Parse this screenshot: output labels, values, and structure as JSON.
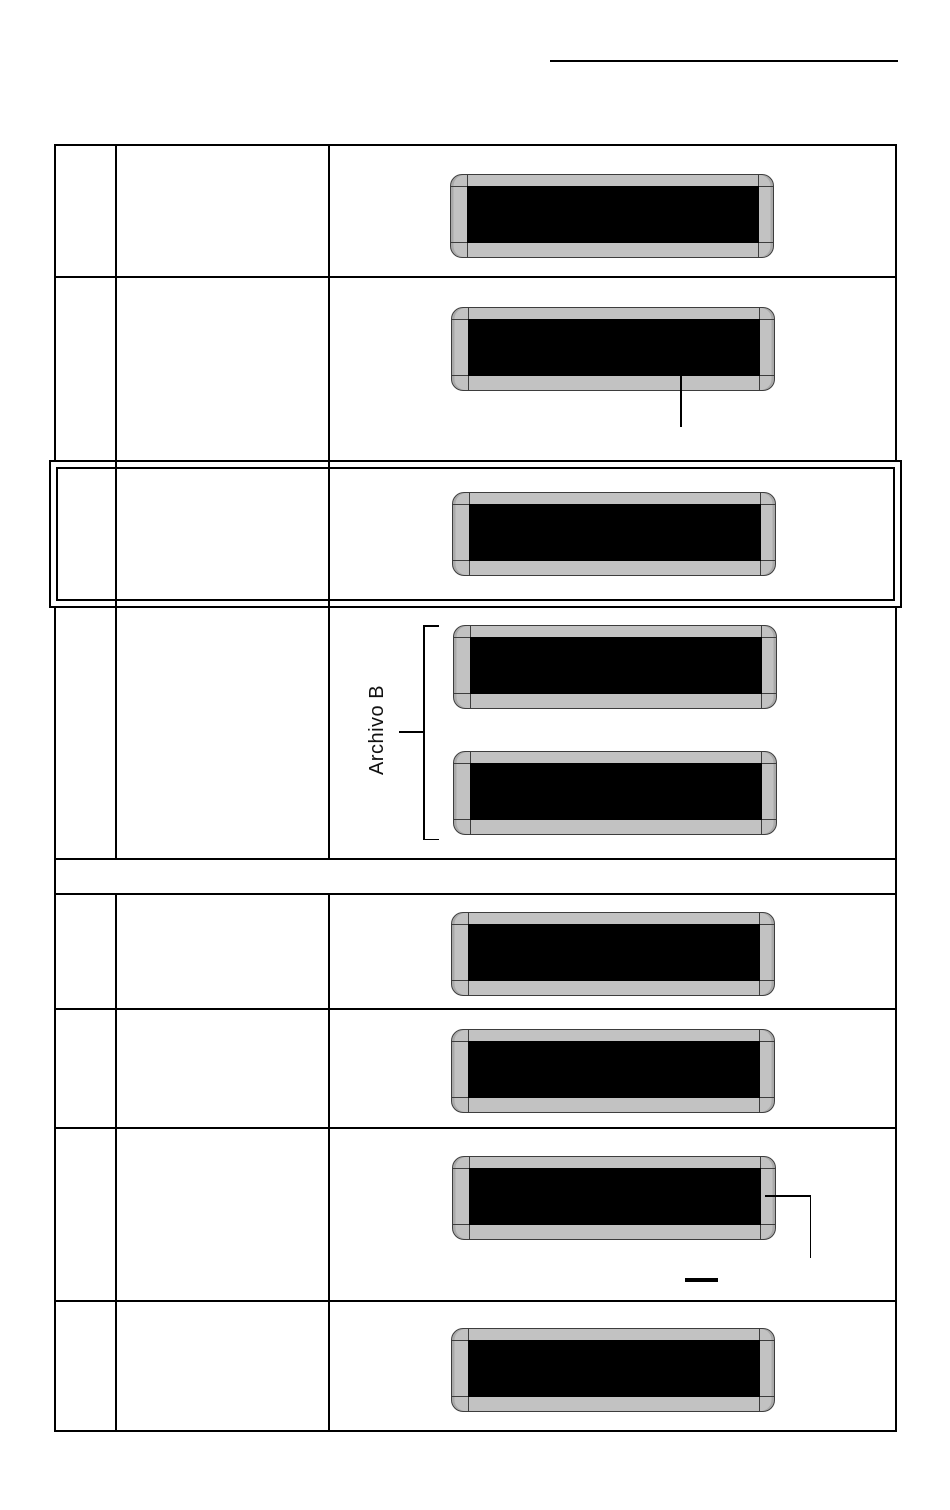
{
  "page": {
    "type": "manual-document-page",
    "background": "#ffffff",
    "header_rule_visible": true
  },
  "labels": {
    "archivo_b": "Archivo B"
  },
  "colors": {
    "table_line": "#000000",
    "lcd_bezel_gray": "#c2c2c2",
    "lcd_screen_black": "#000000",
    "lcd_outline": "#3d3d3d"
  },
  "table": {
    "columns": 3,
    "rows": [
      {
        "index": 1,
        "lcd_displays": 1
      },
      {
        "index": 2,
        "lcd_displays": 1,
        "callout": "line-down-from-display-bottom"
      },
      {
        "index": 3,
        "lcd_displays": 1,
        "highlighted": "double-border-box"
      },
      {
        "index": 4,
        "lcd_displays": 2,
        "bracket_label": "Archivo B"
      },
      {
        "index": 5,
        "separator_row": true,
        "lcd_displays": 0
      },
      {
        "index": 6,
        "lcd_displays": 1
      },
      {
        "index": 7,
        "lcd_displays": 1
      },
      {
        "index": 8,
        "lcd_displays": 1,
        "callout": "line-right-then-down",
        "dash_mark": true
      },
      {
        "index": 9,
        "lcd_displays": 1
      }
    ]
  }
}
